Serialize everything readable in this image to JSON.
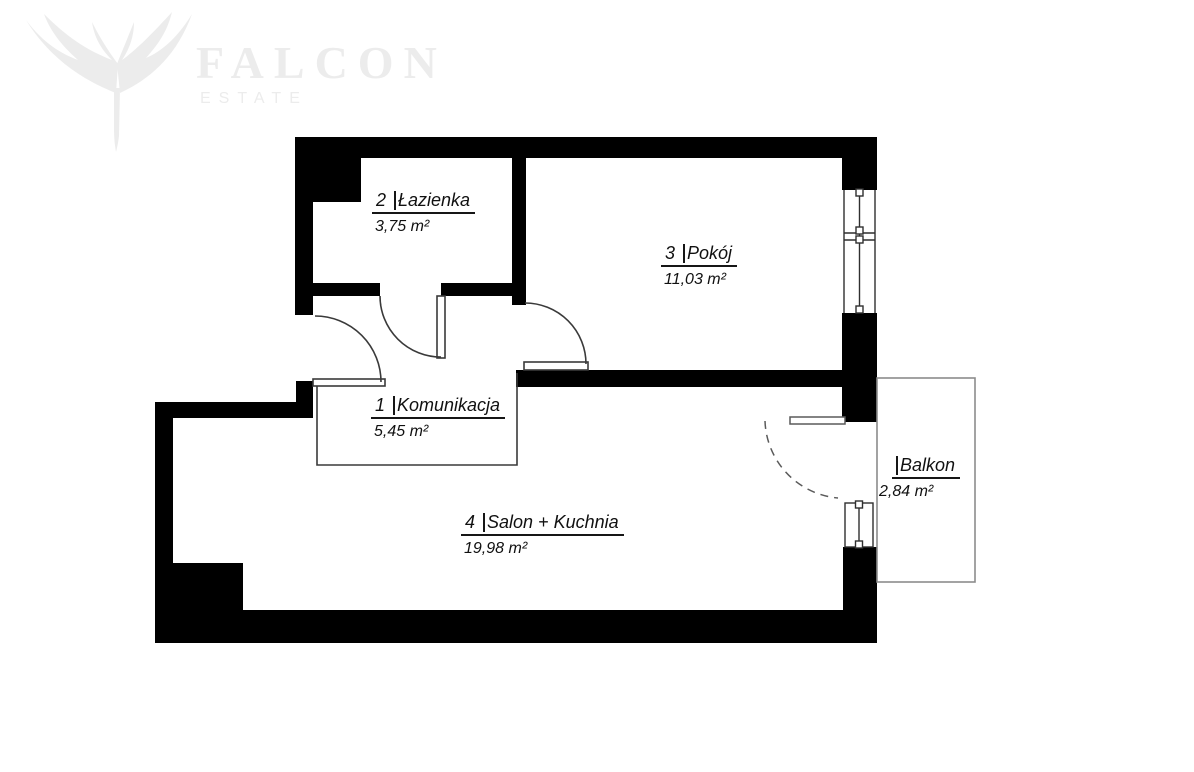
{
  "logo": {
    "brand": "FALCON",
    "tagline": "ESTATE"
  },
  "floor_plan": {
    "title": "Apartment floor plan",
    "rooms": [
      {
        "id": "lazienka",
        "number": "2",
        "name": "Łazienka",
        "area": "3,75 m²"
      },
      {
        "id": "pokoj",
        "number": "3",
        "name": "Pokój",
        "area": "11,03 m²"
      },
      {
        "id": "komunikacja",
        "number": "1",
        "name": "Komunikacja",
        "area": "5,45 m²"
      },
      {
        "id": "salon-kuchnia",
        "number": "4",
        "name": "Salon + Kuchnia",
        "area": "19,98 m²"
      },
      {
        "id": "balkon",
        "number": "",
        "name": "Balkon",
        "area": "2,84 m²"
      }
    ],
    "colors": {
      "wall": "#000000",
      "thin_line": "#3a3a3a",
      "window_line": "#2f2f2f",
      "balcony_line": "#8c8c8c",
      "dashed_door_line": "#5a5a5a",
      "text": "#111111",
      "watermark": "#ececec",
      "background": "#ffffff"
    }
  }
}
